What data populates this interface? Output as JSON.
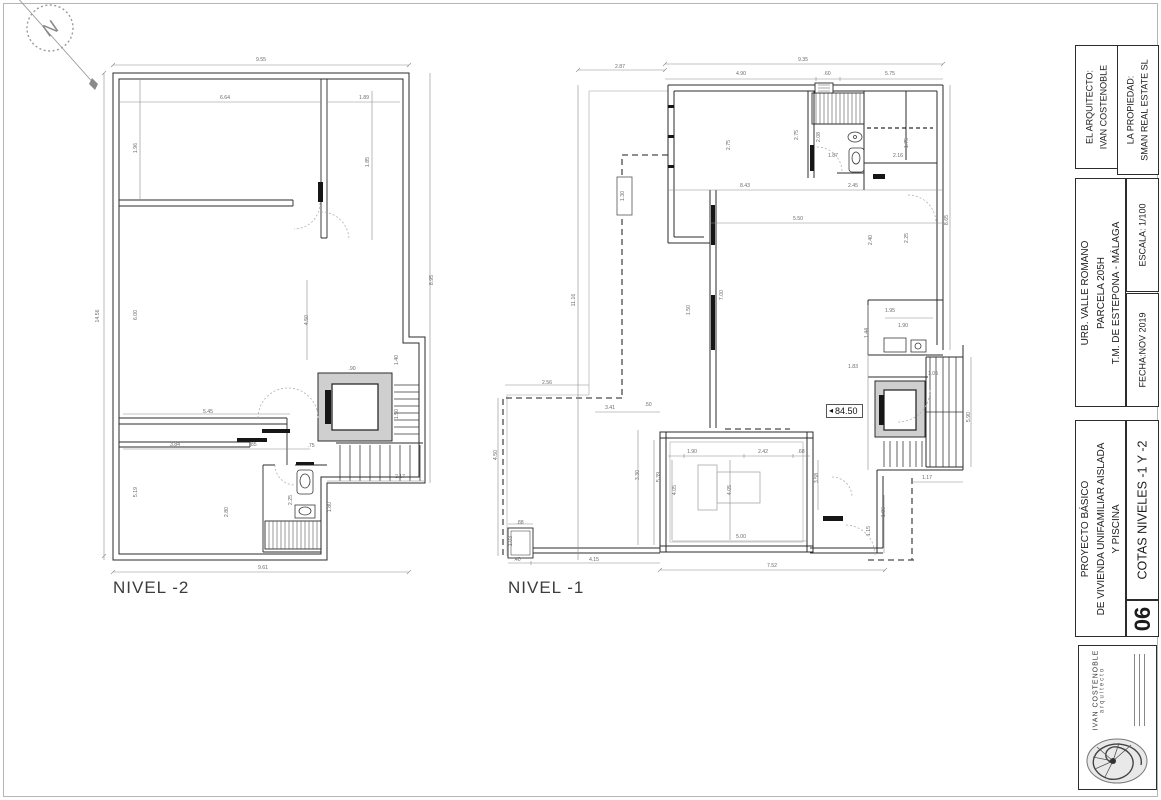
{
  "compass": {
    "label": "N"
  },
  "plans": [
    {
      "title": "NIVEL -2",
      "dims": [
        {
          "x": 261,
          "y": 61,
          "t": "9.55"
        },
        {
          "x": 225,
          "y": 99,
          "t": "6.64"
        },
        {
          "x": 364,
          "y": 99,
          "t": "1.89"
        },
        {
          "x": 99,
          "y": 316,
          "t": "14.56",
          "r": 90
        },
        {
          "x": 137,
          "y": 148,
          "t": "1.96",
          "r": 90
        },
        {
          "x": 369,
          "y": 162,
          "t": "1.85",
          "r": 90
        },
        {
          "x": 433,
          "y": 280,
          "t": "8.95",
          "r": 90
        },
        {
          "x": 137,
          "y": 315,
          "t": "6.00",
          "r": 90
        },
        {
          "x": 308,
          "y": 320,
          "t": "4.50",
          "r": 90
        },
        {
          "x": 208,
          "y": 413,
          "t": "5.45"
        },
        {
          "x": 175,
          "y": 446,
          "t": "3.84"
        },
        {
          "x": 253,
          "y": 446,
          "t": ".85"
        },
        {
          "x": 137,
          "y": 492,
          "t": "5.19",
          "r": 90
        },
        {
          "x": 263,
          "y": 569,
          "t": "9.61"
        },
        {
          "x": 292,
          "y": 500,
          "t": "2.25",
          "r": 90
        },
        {
          "x": 331,
          "y": 507,
          "t": "1.80",
          "r": 90
        },
        {
          "x": 228,
          "y": 512,
          "t": "2.80",
          "r": 90
        },
        {
          "x": 400,
          "y": 478,
          "t": "2.17"
        },
        {
          "x": 398,
          "y": 360,
          "t": "1.40",
          "r": 90
        },
        {
          "x": 352,
          "y": 370,
          "t": ".90"
        },
        {
          "x": 311,
          "y": 447,
          "t": ".75"
        },
        {
          "x": 398,
          "y": 414,
          "t": "1.50",
          "r": 90
        }
      ]
    },
    {
      "title": "NIVEL -1",
      "level_marker": "84.50",
      "dims": [
        {
          "x": 803,
          "y": 61,
          "t": "9.35"
        },
        {
          "x": 620,
          "y": 68,
          "t": "2.87"
        },
        {
          "x": 741,
          "y": 75,
          "t": "4.90"
        },
        {
          "x": 827,
          "y": 75,
          "t": ".60"
        },
        {
          "x": 890,
          "y": 75,
          "t": "5.75"
        },
        {
          "x": 575,
          "y": 300,
          "t": "11.16",
          "r": 90
        },
        {
          "x": 624,
          "y": 196,
          "t": "1.30",
          "r": 90
        },
        {
          "x": 730,
          "y": 145,
          "t": "2.75",
          "r": 90
        },
        {
          "x": 798,
          "y": 135,
          "t": "2.75",
          "r": 90
        },
        {
          "x": 820,
          "y": 137,
          "t": "2.08",
          "r": 90
        },
        {
          "x": 908,
          "y": 143,
          "t": "1.75",
          "r": 90
        },
        {
          "x": 833,
          "y": 157,
          "t": "1.87"
        },
        {
          "x": 898,
          "y": 157,
          "t": "2.16"
        },
        {
          "x": 745,
          "y": 187,
          "t": "8.43"
        },
        {
          "x": 853,
          "y": 187,
          "t": "2.45"
        },
        {
          "x": 948,
          "y": 220,
          "t": "8.65",
          "r": 90
        },
        {
          "x": 723,
          "y": 295,
          "t": "7.00",
          "r": 90
        },
        {
          "x": 690,
          "y": 310,
          "t": "1.50",
          "r": 90
        },
        {
          "x": 798,
          "y": 220,
          "t": "5.50"
        },
        {
          "x": 872,
          "y": 240,
          "t": "2.40",
          "r": 90
        },
        {
          "x": 908,
          "y": 238,
          "t": "2.25",
          "r": 90
        },
        {
          "x": 890,
          "y": 312,
          "t": "1.95"
        },
        {
          "x": 903,
          "y": 327,
          "t": "1.90"
        },
        {
          "x": 868,
          "y": 333,
          "t": "1.44",
          "r": 90
        },
        {
          "x": 853,
          "y": 368,
          "t": "1.83"
        },
        {
          "x": 970,
          "y": 417,
          "t": "5.90",
          "r": 90
        },
        {
          "x": 933,
          "y": 375,
          "t": "1.06"
        },
        {
          "x": 692,
          "y": 453,
          "t": "1.90"
        },
        {
          "x": 763,
          "y": 453,
          "t": "2.42"
        },
        {
          "x": 801,
          "y": 453,
          ".t": "",
          "t": ".68"
        },
        {
          "x": 741,
          "y": 538,
          "t": "5.00"
        },
        {
          "x": 676,
          "y": 490,
          "t": "4.05",
          "r": 90
        },
        {
          "x": 731,
          "y": 490,
          "t": "4.05",
          "r": 90
        },
        {
          "x": 660,
          "y": 477,
          "t": "5.39",
          "r": 90
        },
        {
          "x": 639,
          "y": 475,
          "t": "3.30",
          "r": 90
        },
        {
          "x": 818,
          "y": 478,
          "t": "3.58",
          "r": 90
        },
        {
          "x": 610,
          "y": 409,
          "t": "3.41"
        },
        {
          "x": 648,
          "y": 406,
          "t": ".50"
        },
        {
          "x": 594,
          "y": 561,
          "t": "4.15"
        },
        {
          "x": 517,
          "y": 561,
          "t": ".40"
        },
        {
          "x": 772,
          "y": 567,
          "t": "7.52"
        },
        {
          "x": 497,
          "y": 455,
          "t": "4.50",
          "r": 90
        },
        {
          "x": 512,
          "y": 541,
          "t": "1.03",
          "r": 90
        },
        {
          "x": 520,
          "y": 524,
          "t": ".88"
        },
        {
          "x": 547,
          "y": 384,
          "t": "2.56"
        },
        {
          "x": 927,
          "y": 479,
          "t": "1.17"
        },
        {
          "x": 885,
          "y": 512,
          "t": "1.86",
          "r": 90
        },
        {
          "x": 870,
          "y": 531,
          "t": "1.15",
          "r": 90
        }
      ]
    }
  ],
  "titleblock": {
    "architect_label": "EL ARQUITECTO:",
    "architect_name": "IVAN COSTENOBLE",
    "owner_label": "LA PROPIEDAD:",
    "owner_name": "SMAN REAL ESTATE SL",
    "location_line1": "URB. VALLE ROMANO",
    "location_line2": "PARCELA 205H",
    "location_line3": "T.M. DE ESTEPONA - MÁLAGA",
    "scale": "ESCALA: 1/100",
    "date": "FECHA:NOV 2019",
    "project_line1": "PROYECTO BÁSICO",
    "project_line2": "DE VIVIENDA UNIFAMILIAR AISLADA",
    "project_line3": "Y PISCINA",
    "sheet_title": "COTAS NIVELES -1 Y -2",
    "sheet_number": "06"
  },
  "stamp": {
    "name": "IVAN COSTENOBLE",
    "role": "arquitecto"
  }
}
